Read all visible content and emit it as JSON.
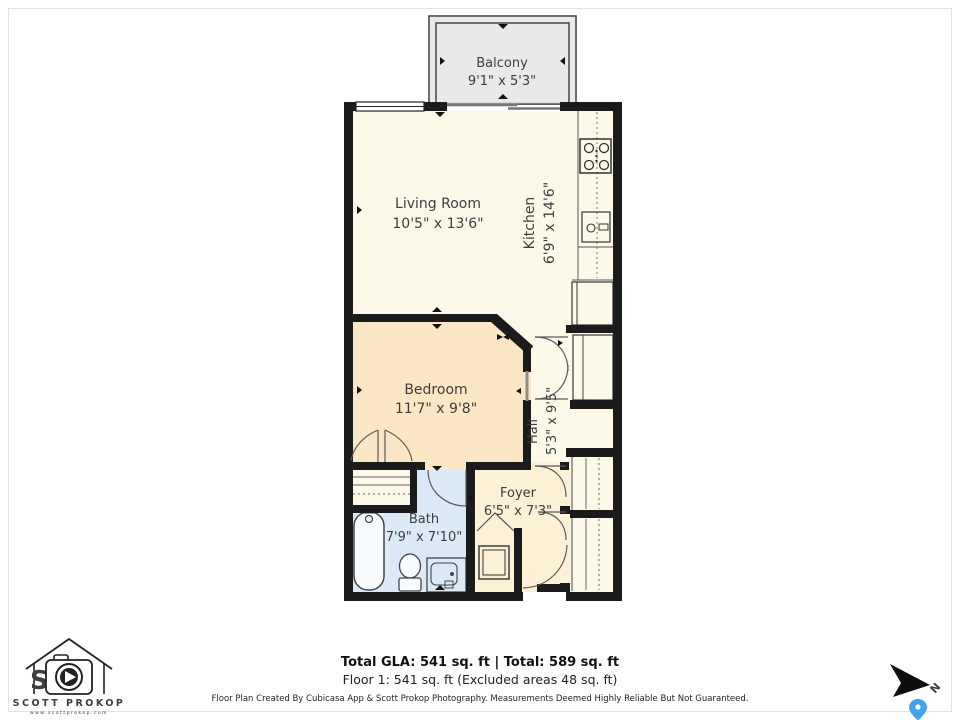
{
  "plan": {
    "colors": {
      "wall": "#1b1b1b",
      "floor_main": "#fdf9e8",
      "floor_bedroom": "#fbe7c3",
      "floor_bath": "#dceaf7",
      "floor_foyer": "#fcf0d5",
      "floor_balcony": "#e9e9e9"
    },
    "rooms": {
      "balcony": {
        "name": "Balcony",
        "dims": "9'1\" x 5'3\""
      },
      "living_room": {
        "name": "Living Room",
        "dims": "10'5\" x 13'6\""
      },
      "kitchen": {
        "name": "Kitchen",
        "dims": "6'9\" x 14'6\""
      },
      "bedroom": {
        "name": "Bedroom",
        "dims": "11'7\" x 9'8\""
      },
      "hall": {
        "name": "Hall",
        "dims": "5'3\" x 9'5\""
      },
      "foyer": {
        "name": "Foyer",
        "dims": "6'5\" x 7'3\""
      },
      "bath": {
        "name": "Bath",
        "dims": "7'9\" x 7'10\""
      }
    }
  },
  "footer": {
    "totals_line": "Total GLA: 541 sq. ft | Total: 589 sq. ft",
    "floor_line": "Floor 1: 541 sq. ft (Excluded areas 48 sq. ft)",
    "disclaimer": "Floor Plan Created By Cubicasa App & Scott Prokop Photography. Measurements Deemed Highly Reliable But Not Guaranteed."
  },
  "branding": {
    "logo_name": "SCOTT PROKOP",
    "logo_url": "www.scottprokop.com"
  },
  "compass": {
    "north_label": "N"
  }
}
